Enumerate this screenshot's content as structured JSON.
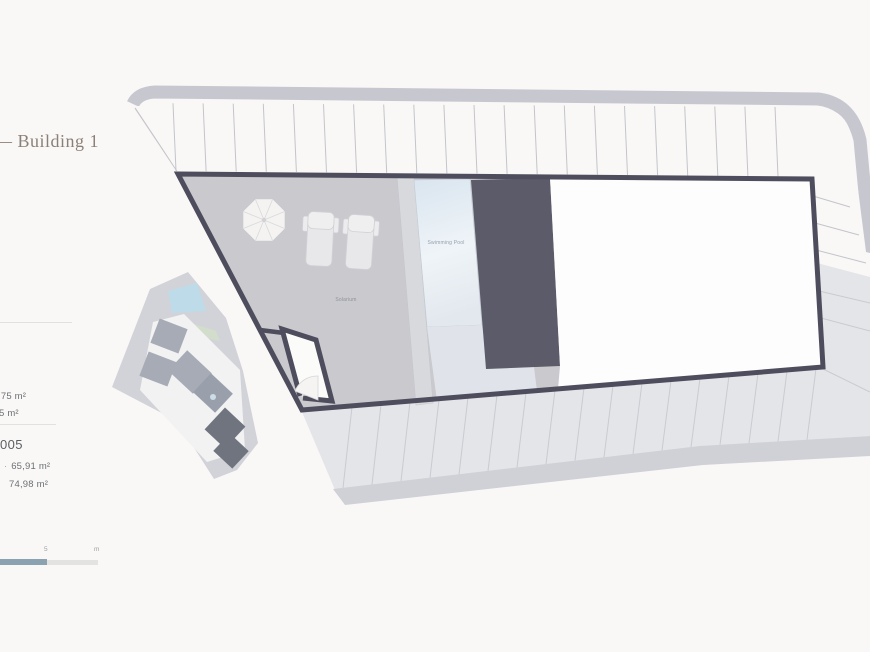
{
  "header": {
    "title": "— Building 1"
  },
  "info_panel": {
    "summary": {
      "line1": ",75 m²",
      "line2": "5 m²"
    },
    "unit": {
      "number": "005",
      "bullet": "·",
      "area1": "65,91 m²",
      "area2": "74,98 m²"
    }
  },
  "plan": {
    "labels": {
      "swimming_pool": "Swimming Pool",
      "solarium": "Solarium"
    }
  },
  "scale_bar": {
    "mid_label": "5",
    "unit_label": "m"
  },
  "colors": {
    "background": "#faf8f6",
    "plan_outline": "#4d4d5d",
    "core_fill": "#5b5b69",
    "terrace": "#c9c9ce",
    "pool_top": "#d9e5ef",
    "pool_bottom": "#eef3f7",
    "paving": "#e4e5e9",
    "curb_band": "#c7c8cf",
    "scale_dark": "#8ba3b1",
    "accent_text": "#8b8077"
  }
}
